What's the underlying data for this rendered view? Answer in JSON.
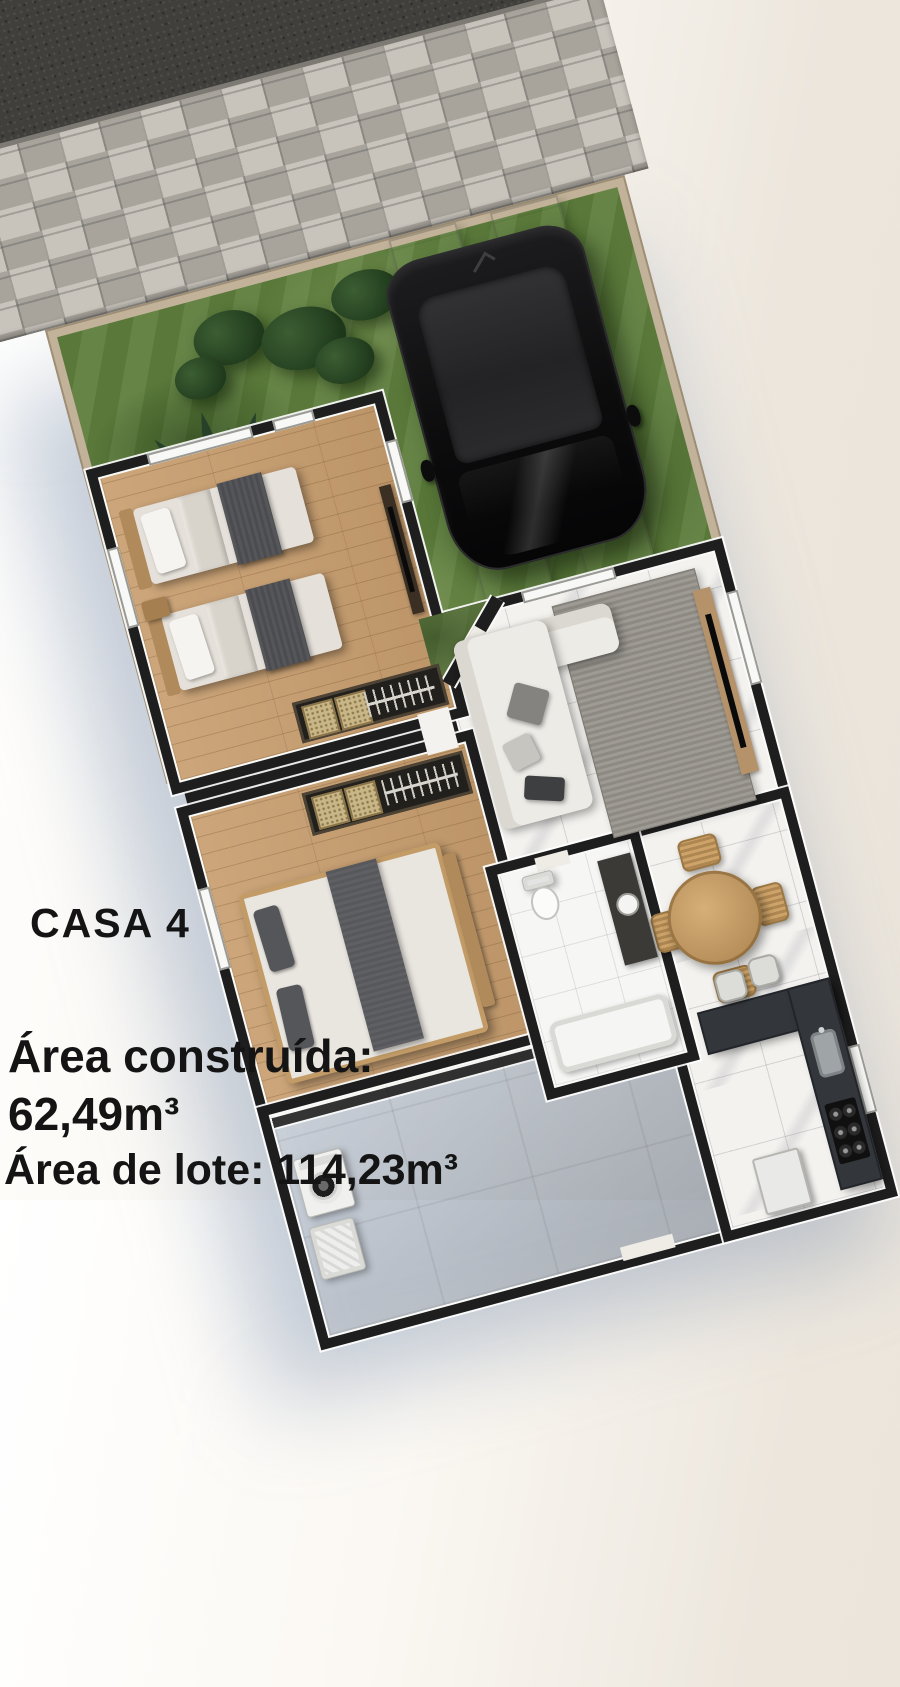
{
  "title": "CASA 4",
  "area_info": {
    "built_label": "Área construída:",
    "built_value": "62,49m³",
    "lot_line": "Área de lote: 114,23m³"
  },
  "palette": {
    "asphalt": "#413f3c",
    "pavers": "#bdb8b0",
    "lot_wall": "#c2b29a",
    "grass": "#5d7d3c",
    "interior_wall": "#1e1e1e",
    "wood_floor": "#c89e6f",
    "marble_floor": "#f3f2ef",
    "patio_concrete": "#a8a49c",
    "kitchen_counter": "#33363a",
    "car_body": "#0c0c0d",
    "rug": "#98948d",
    "table_wood": "#b8905c",
    "shadow_blue": "#7890ac"
  },
  "scene_elements": [
    "asphalt-road",
    "paver-sidewalk",
    "lawn",
    "palm-tree",
    "shrubs",
    "driveway-strips",
    "suv-car",
    "twin-bedroom",
    "master-bedroom",
    "closets",
    "living-room",
    "sofa",
    "rug",
    "tv-console",
    "dining-table",
    "bathroom",
    "kitchen-counter",
    "stove",
    "sink",
    "stools",
    "fridge",
    "washing-machine",
    "laundry-tank",
    "patio"
  ]
}
